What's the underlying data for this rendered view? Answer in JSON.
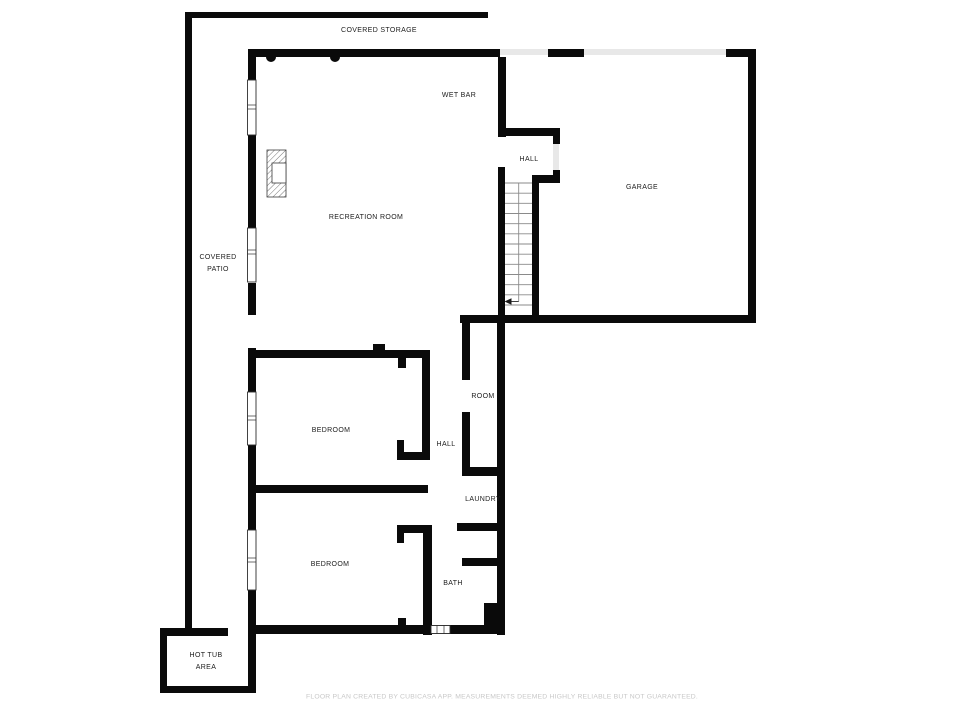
{
  "labels": {
    "covered_storage": "COVERED STORAGE",
    "wet_bar": "WET BAR",
    "hall_upper": "HALL",
    "garage": "GARAGE",
    "recreation_room": "RECREATION ROOM",
    "covered_patio": "COVERED\nPATIO",
    "room": "ROOM",
    "bedroom_upper": "BEDROOM",
    "hall_lower": "HALL",
    "laundry": "LAUNDRY",
    "bedroom_lower": "BEDROOM",
    "bath": "BATH",
    "hot_tub_area": "HOT TUB\nAREA"
  },
  "footer_text": "FLOOR PLAN CREATED BY CUBICASA APP. MEASUREMENTS DEEMED HIGHLY RELIABLE BUT NOT GUARANTEED.",
  "colors": {
    "wall": "#0a0a0a",
    "background": "#ffffff",
    "label": "#1c1c1c",
    "footer": "#c8c8c8",
    "door_gap": "#e8e8e8",
    "stair_line": "#8a8a8a"
  }
}
